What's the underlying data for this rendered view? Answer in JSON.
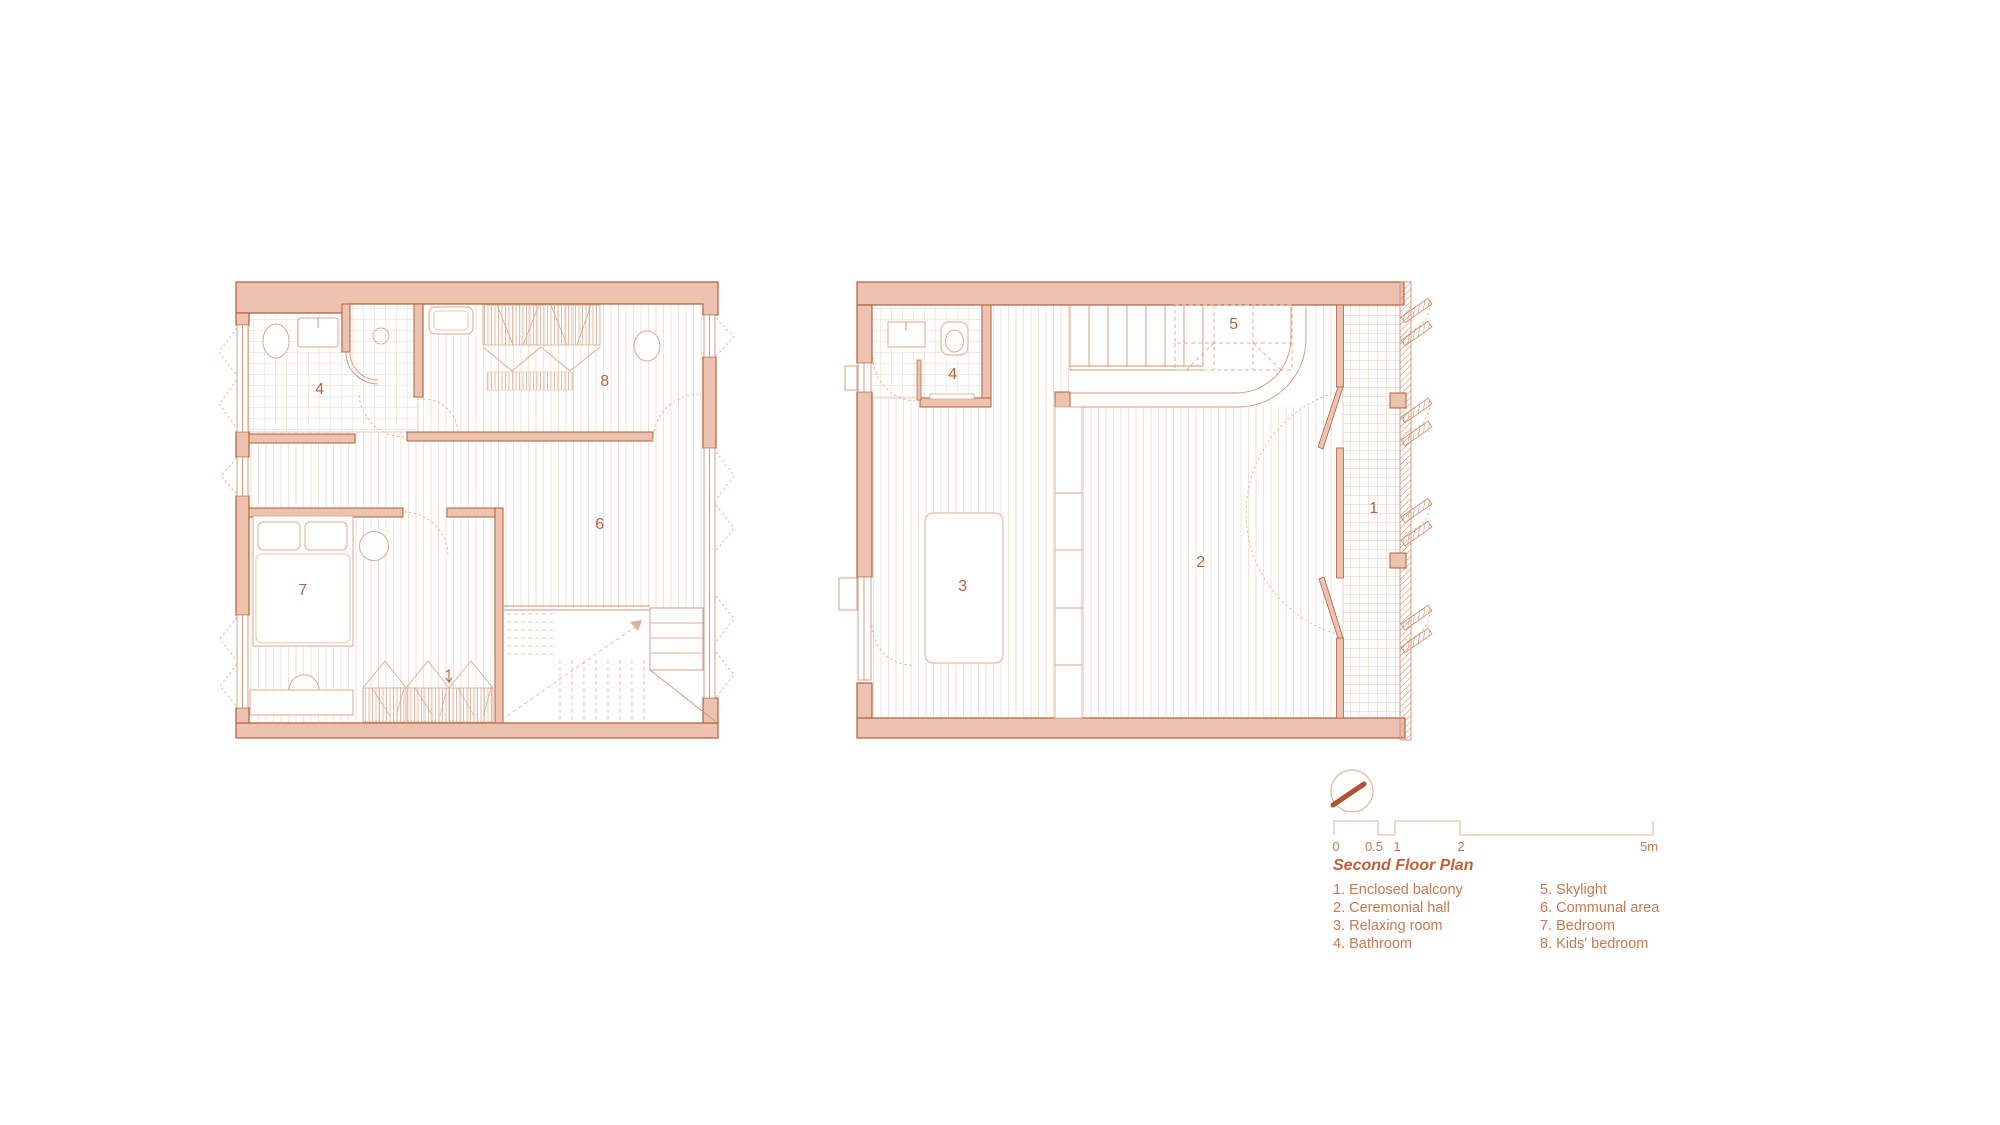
{
  "sheet": {
    "title": "Second Floor Plan",
    "drawing_type": "architectural floor plan"
  },
  "legend": {
    "title": "Second Floor Plan",
    "items": [
      "1. Enclosed balcony",
      "2. Ceremonial hall",
      "3. Relaxing room",
      "4. Bathroom",
      "5. Skylight",
      "6. Communal area",
      "7. Bedroom",
      "8. Kids' bedroom"
    ]
  },
  "scale_bar": {
    "labels": [
      "0",
      "0.5",
      "1",
      "2",
      "5m"
    ],
    "unit": "m"
  },
  "room_labels": {
    "left_bathroom": "4",
    "left_kids_bedroom": "8",
    "left_communal_area": "6",
    "left_bedroom": "7",
    "right_bathroom": "4",
    "right_skylight": "5",
    "right_ceremonial_hall": "2",
    "right_relaxing_room": "3",
    "right_enclosed_balcony": "1"
  },
  "icons": {
    "north": "north-arrow-icon"
  },
  "colors": {
    "wall_fill": "#edc2ae",
    "wall_line": "#b06040",
    "thin_line": "#cf9678",
    "fixture_line": "#dba98e",
    "floor_stripe": "#f4e0d6",
    "tile_grid": "#eed3c3",
    "label_text": "#c05f38",
    "legend_text": "#c97a52",
    "north_bar": "#b35231"
  }
}
